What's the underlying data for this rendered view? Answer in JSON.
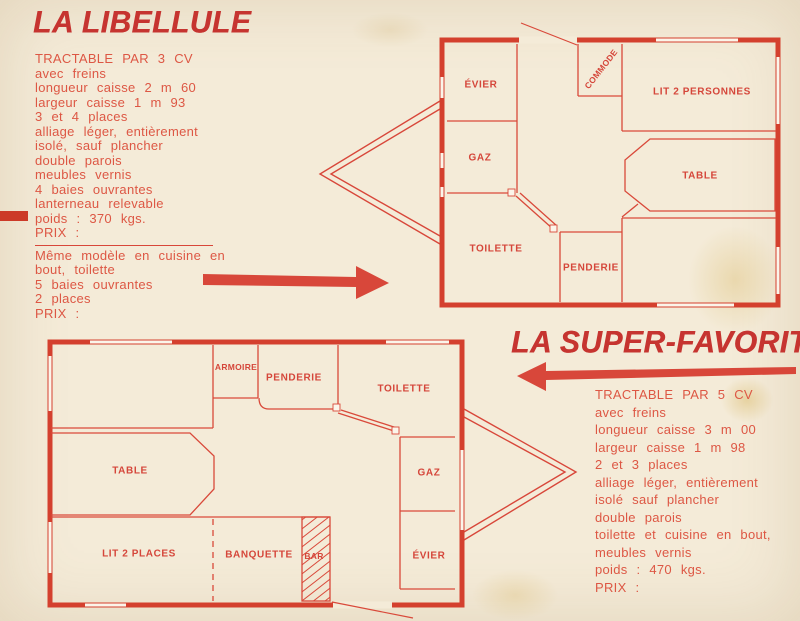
{
  "colors": {
    "background": "#f4ebd8",
    "text_red": "#dd5744",
    "title_red": "#c63430",
    "wall_red": "#d4402e",
    "line_red": "#d9493a"
  },
  "libellule": {
    "title": "LA LIBELLULE",
    "specs": [
      "TRACTABLE PAR 3 CV",
      "avec freins",
      "longueur caisse 2 m 60",
      "largeur caisse 1 m 93",
      "3 et 4 places",
      "alliage léger, entièrement",
      "isolé, sauf plancher",
      "double parois",
      "meubles vernis",
      "4 baies ouvrantes",
      "lanterneau relevable",
      "poids : 370 kgs.",
      "PRIX :"
    ],
    "variant_specs": [
      "Même modèle en cuisine en",
      "bout, toilette",
      "5 baies ouvrantes",
      "2 places",
      "PRIX :"
    ],
    "plan": {
      "rooms": {
        "evier": "ÉVIER",
        "gaz": "GAZ",
        "toilette": "TOILETTE",
        "commode": "COMMODE",
        "lit": "LIT 2 PERSONNES",
        "table": "TABLE",
        "penderie": "PENDERIE"
      }
    }
  },
  "super_favorite": {
    "title": "LA SUPER-FAVORITE",
    "specs": [
      "TRACTABLE PAR 5 CV",
      "avec freins",
      "longueur caisse 3 m 00",
      "largeur caisse 1 m 98",
      "2 et 3 places",
      "alliage léger, entièrement",
      "isolé sauf plancher",
      "double parois",
      "toilette et cuisine en bout,",
      "meubles vernis",
      "poids : 470 kgs.",
      "PRIX :"
    ],
    "plan": {
      "rooms": {
        "armoire": "ARMOIRE",
        "penderie": "PENDERIE",
        "toilette": "TOILETTE",
        "table": "TABLE",
        "gaz": "GAZ",
        "evier": "ÉVIER",
        "lit": "LIT 2 PLACES",
        "banquette": "BANQUETTE",
        "bar": "BAR"
      }
    }
  }
}
